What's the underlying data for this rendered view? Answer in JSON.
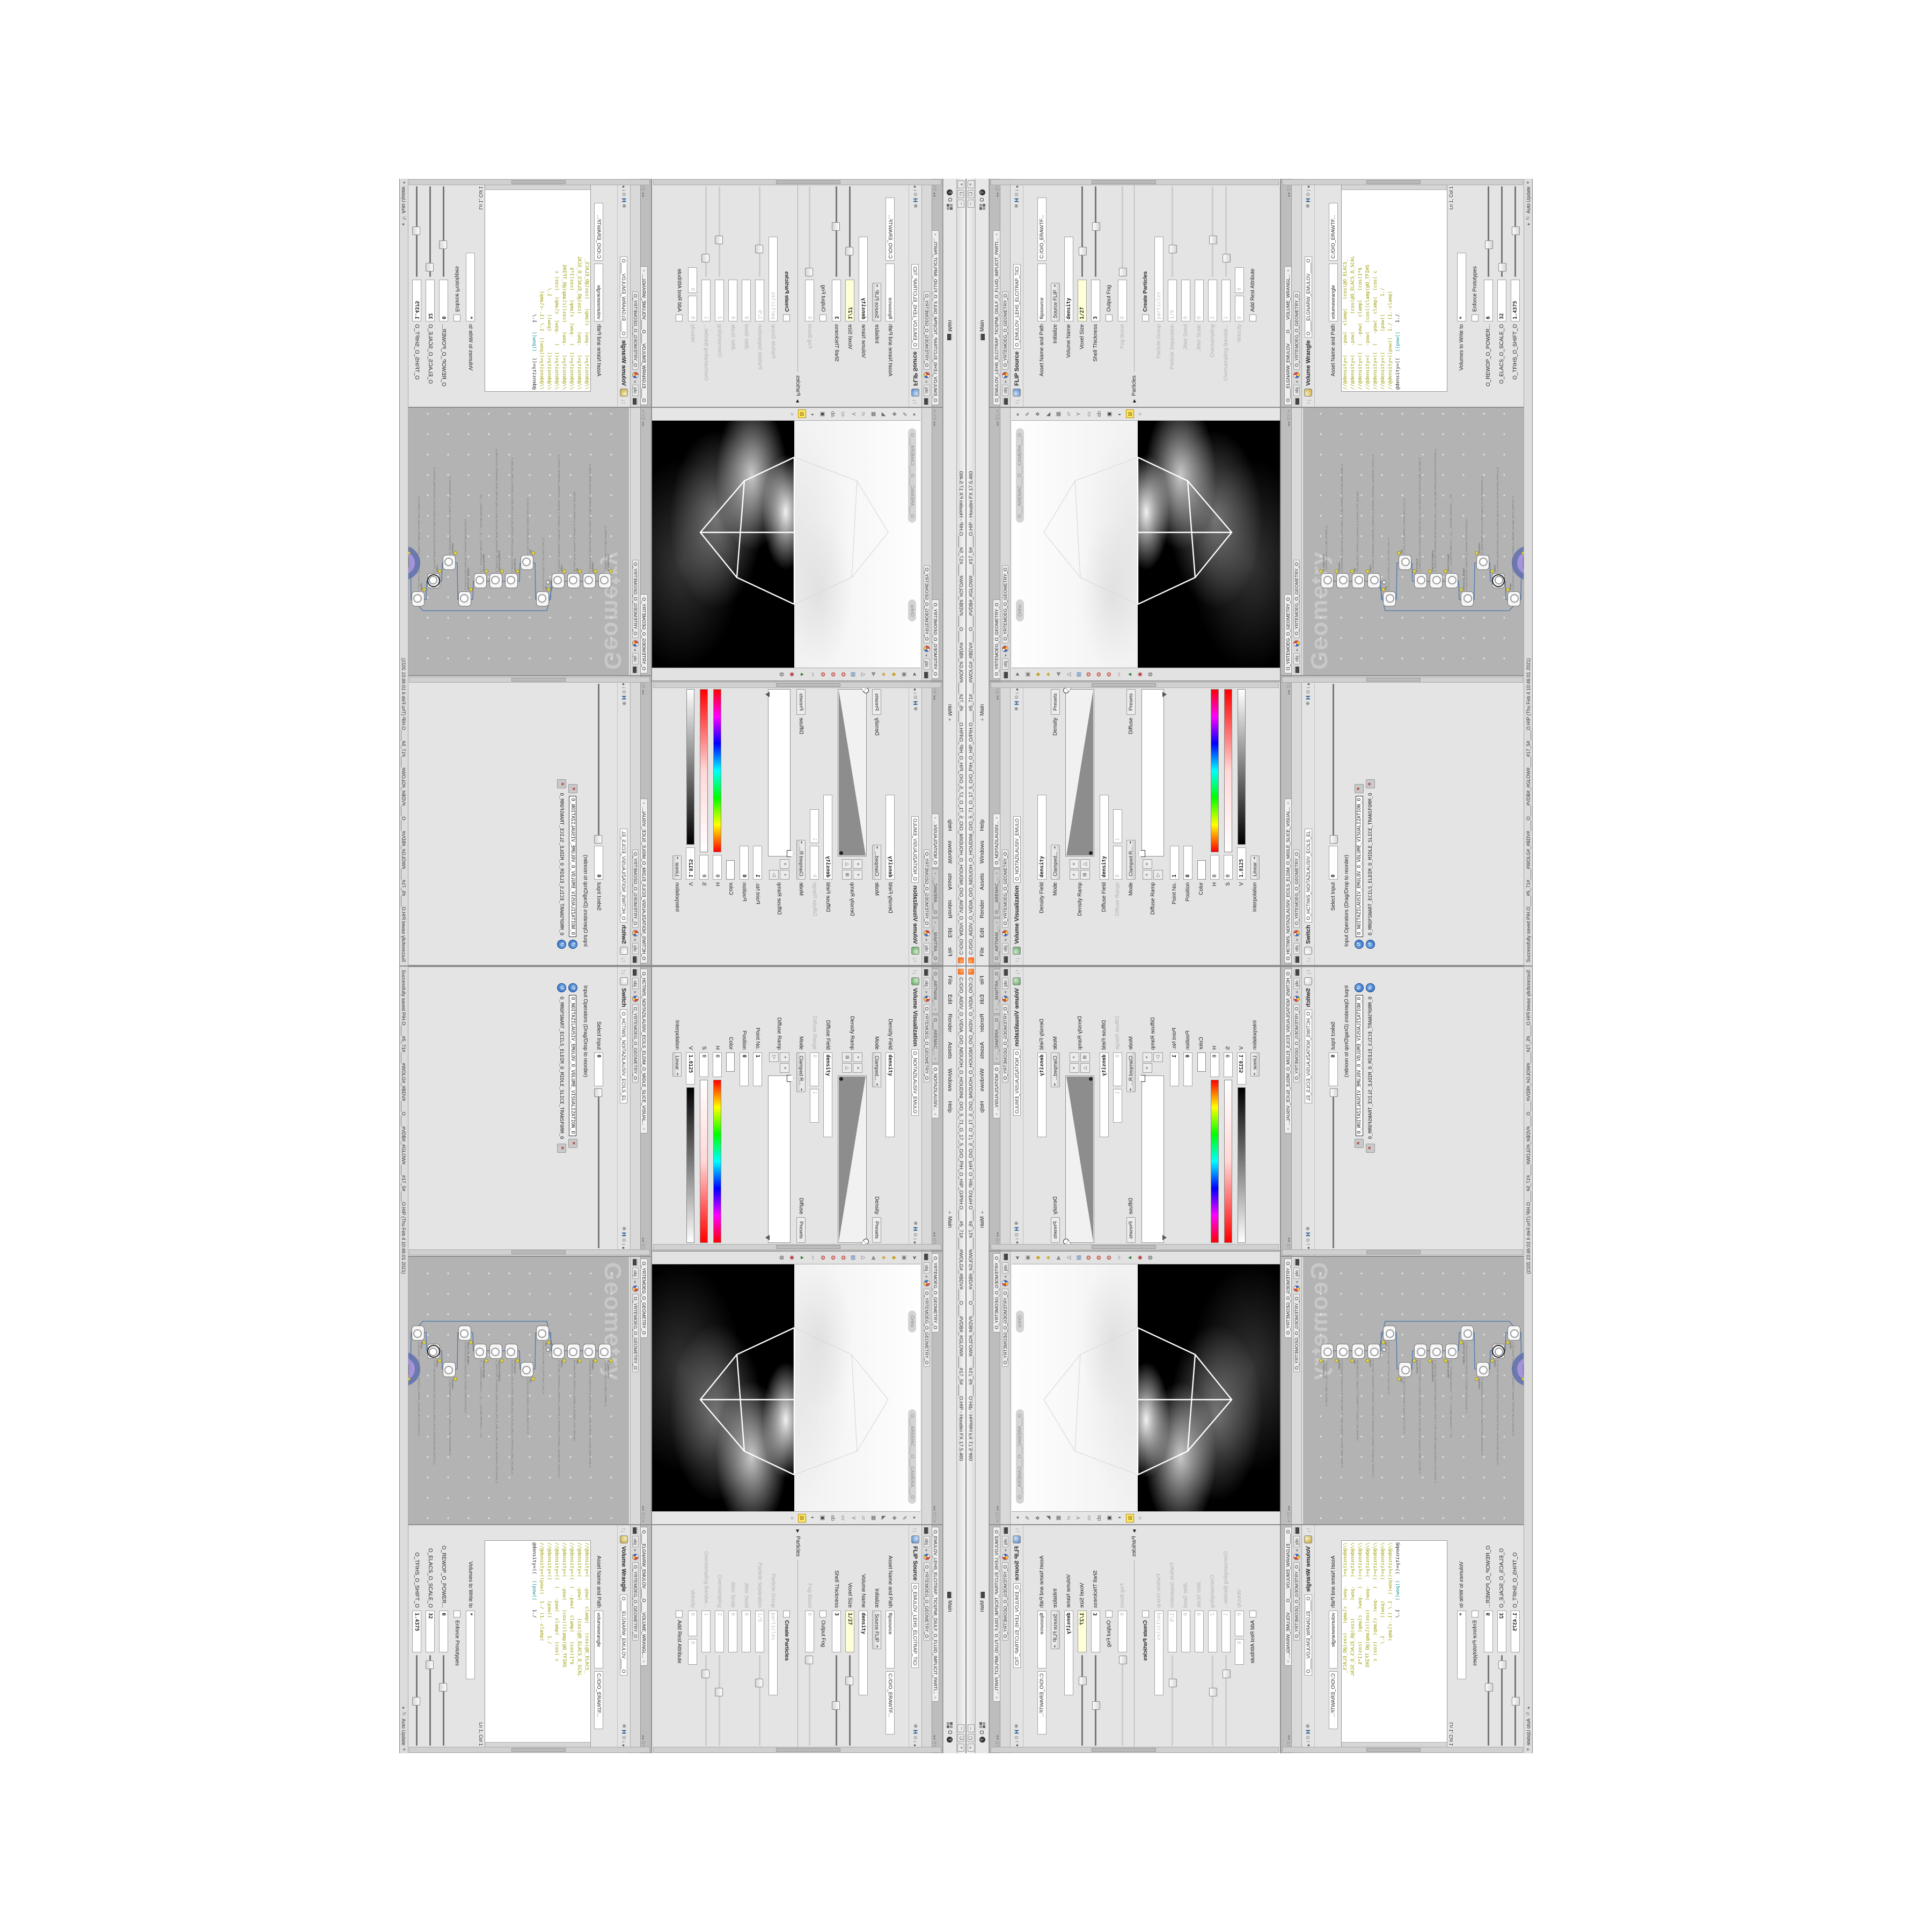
{
  "window": {
    "title": "C:/O/O_AIDIV_O_VIDIA_O/O_NIDUOH_O_HOUDINI_O/O_5_71_O_17_5_O/O_PIH_O_HIP_O/PIH.O____#5_71#____#WOLG#_#BDV#____O____#VDB#_#GLOW#____#17_5#____O.HIP - Houdini FX 17.5.460",
    "buttons": [
      "–",
      "❏",
      "×"
    ]
  },
  "menu": {
    "items": [
      "File",
      "Edit",
      "Render",
      "Assets",
      "Windows",
      "Help"
    ],
    "desktop_label": "Main",
    "desktop2_label": "Main",
    "right_o": "O"
  },
  "path": {
    "root": "obj",
    "node": "O_YRTEMOEG_O_GEOMETRY_O"
  },
  "statusbar": {
    "message": "Successfully saved PIH.O____#5_71#____#WOLG#_#BDV#____O____#VDB#_#GLOW#____#17_5#____O.HIP (Thu Feb  4 10:46:01 2021)",
    "auto_update": "Auto Update"
  },
  "viewport": {
    "tabs": [
      {
        "t": "O_YRTEMOEG_O_GEOMETRY_O",
        "active": true
      }
    ],
    "ortho_pill": "Ortho",
    "camera_pill": "O___AREMAC___O___CAMERA___O",
    "left_icons": [
      {
        "g": "➤",
        "c": "#555"
      },
      {
        "g": "▣",
        "c": "#777"
      },
      {
        "g": "◆",
        "c": "#c9a227"
      },
      {
        "g": "◈",
        "c": "#c9a227"
      },
      {
        "g": "◀",
        "c": "#888"
      },
      {
        "g": "△",
        "c": "#666"
      },
      {
        "g": "▤",
        "c": "#3a6bb0"
      },
      {
        "g": "❂",
        "c": "#c0392b"
      },
      {
        "g": "❂",
        "c": "#c0392b"
      },
      {
        "g": "❂",
        "c": "#c0392b"
      },
      {
        "g": "✂",
        "c": "#999"
      },
      {
        "g": "▲",
        "c": "#2e7d32"
      },
      {
        "g": "◉",
        "c": "#b03030"
      },
      {
        "g": "◍",
        "c": "#555"
      }
    ],
    "right_icons": [
      {
        "g": "▸",
        "c": "#777"
      },
      {
        "g": "✎",
        "c": "#666"
      },
      {
        "g": "❖",
        "c": "#666"
      },
      {
        "g": "◣",
        "c": "#666"
      },
      {
        "g": "▦",
        "c": "#666"
      },
      {
        "g": "▱",
        "c": "#666"
      },
      {
        "g": "Y",
        "c": "#666"
      },
      {
        "g": "▭",
        "c": "#666"
      },
      {
        "g": "ab",
        "c": "#666"
      },
      {
        "g": "▣",
        "c": "#444"
      },
      {
        "g": "◐",
        "c": "#444"
      },
      {
        "g": "⊞",
        "c": "#806000",
        "hl": true
      },
      {
        "g": "○",
        "c": "#555"
      }
    ]
  },
  "flip": {
    "tabs": [
      {
        "t": "O_EMULOV_LEHS_ELCITRAP_TICI(PMI_DIULF_O_FLUID_IMPLICIT_PARTI...",
        "x": true,
        "active": true
      }
    ],
    "header": {
      "title": "FLIP Source",
      "field": "O_EMULOV_LEHS_ELCITRAP_TICI"
    },
    "params": [
      {
        "label": "Asset Name and Path",
        "fields": [
          {
            "v": "flipsource",
            "w": 100
          },
          {
            "v": "C:/O/O_ERAWTF...",
            "w": 110
          }
        ]
      },
      {
        "label": "Initialize",
        "menu": "Source FLIP"
      },
      {
        "label": "Volume Name",
        "fields": [
          {
            "v": "density",
            "w": 150,
            "mono": true,
            "bold": true
          }
        ]
      },
      {
        "label": "Voxel Size",
        "fields": [
          {
            "v": "1/27",
            "w": 70,
            "mono": true,
            "bold": true,
            "yellow": true
          }
        ],
        "slider": 0.28
      },
      {
        "label": "Shell Thickness",
        "fields": [
          {
            "v": "3",
            "w": 70,
            "mono": true,
            "bold": true
          }
        ],
        "slider": 0.55
      },
      {
        "check": "Output Fog",
        "checked": false
      },
      {
        "label": "Fog Boost",
        "grey": true,
        "fields": [
          {
            "v": "0",
            "w": 70,
            "mono": true,
            "grey": true
          }
        ],
        "slider": 0.05,
        "sliderGrey": true
      },
      {
        "sep": "Particles"
      },
      {
        "check": "Create Particles",
        "bold": true,
        "checked": false
      },
      {
        "label": "Particle Group",
        "grey": true,
        "fields": [
          {
            "v": "particles",
            "w": 150,
            "mono": true,
            "grey": true
          }
        ]
      },
      {
        "label": "Particle Separation",
        "grey": true,
        "fields": [
          {
            "v": "1/9",
            "w": 70,
            "mono": true,
            "grey": true
          }
        ],
        "slider": 0.3,
        "sliderGrey": true
      },
      {
        "label": "Jitter Seed",
        "grey": true,
        "fields": [
          {
            "v": "0",
            "w": 70,
            "mono": true,
            "grey": true
          }
        ]
      },
      {
        "label": "Jitter Scale",
        "grey": true,
        "fields": [
          {
            "v": "0",
            "w": 70,
            "mono": true,
            "grey": true
          }
        ]
      },
      {
        "label": "Oversampling",
        "grey": true,
        "fields": [
          {
            "v": "2",
            "w": 70,
            "mono": true,
            "grey": true
          }
        ],
        "slider": 0.4,
        "sliderGrey": true
      },
      {
        "label": "Oversampling Bandwi...",
        "grey": true,
        "fields": [
          {
            "v": "1",
            "w": 70,
            "mono": true,
            "grey": true
          }
        ],
        "slider": 0.2,
        "sliderGrey": true
      },
      {
        "label": "Velocity",
        "grey": true,
        "fields": [
          {
            "v": "0",
            "w": 40,
            "mono": true,
            "grey": true
          },
          {
            "v": "0",
            "w": 40,
            "mono": true,
            "grey": true
          }
        ]
      },
      {
        "check": "Add Rest Attribute",
        "checked": false
      }
    ]
  },
  "volviz": {
    "tabs": [
      {
        "t": "O__ARTNAM_...",
        "x": true
      },
      {
        "t": "O___AREMAC_...",
        "x": true
      },
      {
        "t": "O_NOITAZILAUSIV...",
        "x": true,
        "active": true
      }
    ],
    "header": {
      "title": "Volume Visualization",
      "field": "O_NOITAZILAUSIV_EMULO"
    },
    "params": [
      {
        "label": "Density Field",
        "fields": [
          {
            "v": "density",
            "w": 150,
            "mono": true,
            "bold": true
          }
        ]
      },
      {
        "label": "Mode",
        "menu": "Clamped...",
        "after": "Density",
        "btn": "Presets"
      },
      {
        "label": "Density Ramp",
        "rampWedge": true
      },
      {
        "label": "Diffuse Field",
        "fields": [
          {
            "v": "density",
            "w": 150,
            "mono": true,
            "bold": true
          }
        ]
      },
      {
        "label": "Diffuse Range",
        "grey": true,
        "fields": [
          {
            "v": "0",
            "w": 55,
            "mono": true,
            "grey": true
          },
          {
            "v": "1",
            "w": 55,
            "mono": true,
            "grey": true
          }
        ]
      },
      {
        "label": "Mode",
        "menu": "Clamped R...",
        "after": "Diffuse",
        "btn": "Presets"
      },
      {
        "label": "Diffuse Ramp",
        "rampBar": true
      },
      {
        "label": "Point No.",
        "fields": [
          {
            "v": "1",
            "w": 55,
            "mono": true,
            "bold": true
          }
        ]
      },
      {
        "label": "Position",
        "fields": [
          {
            "v": "0",
            "w": 55,
            "mono": true,
            "bold": true
          }
        ]
      },
      {
        "label": "Color",
        "swatch": "#ffffff"
      },
      {
        "label": "H",
        "fields": [
          {
            "v": "0",
            "w": 38,
            "mono": true
          }
        ],
        "grad": "hue"
      },
      {
        "label": "S",
        "fields": [
          {
            "v": "0",
            "w": 38,
            "mono": true
          }
        ],
        "grad": "sat"
      },
      {
        "label": "V",
        "fields": [
          {
            "v": "1.8125",
            "w": 52,
            "mono": true,
            "bold": true
          }
        ],
        "grad": "val"
      },
      {
        "label": "Interpolation",
        "menu": "Linear"
      }
    ]
  },
  "wrangle": {
    "tabs": [
      {
        "t": "O____ELGNARW_EMULOV____O____VOLUME_WRANGL...",
        "x": true,
        "active": true
      }
    ],
    "header": {
      "title": "Volume Wrangle",
      "field": "O____ELGNARW_EMULOV____O"
    },
    "asset_row": {
      "label": "Asset Name and Path",
      "fields": [
        {
          "v": "volumewrangle",
          "w": 100
        },
        {
          "v": "C:/O/O_ERAWTF...",
          "w": 100
        }
      ]
    },
    "code": [
      {
        "pre": "//@density=(   -pow(  clamp(   (cos(@O_ELACS_"
      },
      {
        "pre": "//@density=(   -pow(      (cos(@O_ELACS_O_SCAL"
      },
      {
        "pre": ""
      },
      {
        "pre": "//@density=((  (  -pow(  clamp(   (cos(1*$"
      },
      {
        "pre": "//@density=(   -pow(   (cos((clamp(@O_TFIHS"
      },
      {
        "pre": ""
      },
      {
        "pre": "//@density=((  (   -pow(  clamp(  (cos( c"
      },
      {
        "pre": "//@density=((       (pow((      1./"
      },
      {
        "pre": "//@density=((pow((  1./ (1.-clamp("
      },
      {
        "pre": ""
      },
      {
        "pre": "@density=((  ",
        "hl": "((pow((",
        "post": "   1./",
        "black": true
      }
    ],
    "ln_col": "Ln 1, Col 1",
    "params": [
      {
        "label": "Volumes to Write to",
        "fields": [
          {
            "v": "*",
            "w": 120,
            "mono": true,
            "bold": true
          }
        ]
      },
      {
        "check": "Enforce Prototypes",
        "checked": false
      },
      {
        "label": "O_REWOP_O_POWER...",
        "fields": [
          {
            "v": "6",
            "w": 70,
            "mono": true,
            "bold": true
          }
        ],
        "slider": 0.35
      },
      {
        "label": "O_ELACS_O_SCALE_O",
        "fields": [
          {
            "v": "32",
            "w": 70,
            "mono": true,
            "bold": true
          }
        ],
        "slider": 0.1
      },
      {
        "label": "O_TFIHS_O_SHIFT_O",
        "fields": [
          {
            "v": "1.4375",
            "w": 70,
            "mono": true,
            "bold": true
          }
        ],
        "slider": 0.5
      }
    ]
  },
  "switch": {
    "tabs": [
      {
        "t": "O_HCTIWS_NOITAZILAUSIV_ECILS_ELDIM_O_MIDLE_SLICE_VISUAL...",
        "x": true,
        "active": true
      }
    ],
    "header": {
      "title": "Switch",
      "field": "O_HCTIWS_NOITAZILAUSIV_ECILS_EL"
    },
    "params": [
      {
        "label": "Select Input",
        "fields": [
          {
            "v": "0",
            "w": 55,
            "mono": true,
            "bold": true
          }
        ],
        "slider": 0.02
      },
      {
        "plain": "Input Operators (Drag/Drop to reorder)"
      },
      {
        "opitem": "O_NOITAZILAUSIV_EMULOV_O_VOLUME_VISUALIZATION_O",
        "boxed": true
      },
      {
        "opitem": "O_MROFSNART_ECILS_ELDIM_O_MIDLE_SLICE_TRANSFORM_O"
      }
    ]
  },
  "network": {
    "tabs": [
      {
        "t": "O_YRTEMOEG_O_GEOMETRY_O",
        "active": true
      }
    ],
    "watermark": "Geometry",
    "nodes": [
      {
        "label": "ae_CubeSphere",
        "name": "O_ERHPS_ENUC_O_CUBE_SPHERE_O",
        "col": 0
      },
      {
        "label": "PolyWire",
        "name": "O_EMARFERIW_NOGYLOP_EREHPS_ENUC_O_CUBE_SPHERE_POLYGON_WIREFRAME_O",
        "col": 0
      },
      {
        "label": "File",
        "name": "JBO.MD3_PETS_TREPOLS_O_SUNEG_O_SLOPERT_STEP_3DM.OBJ",
        "col": 0
      },
      {
        "label": "Switch",
        "name": "O_HCTIWS_YRTEMOEG_LANRETXE_LANRETNI_O_INTERNAL_EXTERNAL_GEOMETRY_SWITCH_O",
        "col": 0
      },
      {
        "label": "Clip",
        "name": "O_PILC_FLAH_TFEL_O_LEFT_HALF_CLIP_O",
        "col": -1
      },
      {
        "label": "Clip",
        "name": "O_PILC_FLAH_THGIR_O_RIGHT_HALF_CLIP_O",
        "col": 1
      },
      {
        "label": "FLIP Source",
        "name": "O_EMULOV_LEHS_ELCITRAP_TICI(PMI_DIULF_O_FLUID_IMPLICIT_PARTICLE_SHEL_VOLUME_O",
        "col": 0
      },
      {
        "label": "VDB from Polygons",
        "name": "O_SNOGYLOP_YRTEMOEG_MORF_EMULOV_BDV_O_VDB_VOLUME_FROM_GEOMETRY_POLYGONS_O",
        "col": 0
      },
      {
        "label": "Volume Wrangle",
        "name": "O____ELGNARW_EMULOV____O____VOLUME_WRANGLE____O2",
        "col": 0
      },
      {
        "label": "Volume Visualization",
        "name": "O_NOITAZILAUSIV_EMULOV_O_VOLUME_VISUALIZATION_O",
        "col": -1
      },
      {
        "label": "Transform",
        "name": "O_MROFSNART_ECILS_ELDIM_O_MIDLE_SLICE_TRANSFORM_O",
        "col": 1
      },
      {
        "label": "Switch",
        "name": "O_HCTIWS_NOITAZILAUSIV_ECILS_ELDIM_O_MIDLE_SLICE_VISUALIZATION_SWITCH_O",
        "col": 0,
        "ring": true
      },
      {
        "label": "Merge",
        "name": "O_ECAFRUS_HTIW_EMULOV_EGREM_O_MERGE_VOLUME_WITH_SURFACE_O",
        "col": -1
      },
      {
        "label": "Transform",
        "name": "O_MROFSNART_TLUSER_O_RESULT_TRANSFORM_O",
        "col": 1,
        "purple": true
      }
    ]
  },
  "header_icons": [
    "✻",
    "H",
    "⊙",
    "i",
    "●",
    "?"
  ],
  "pane_ctl_icons": [
    "◂",
    "▸",
    "▽",
    "□",
    "+"
  ],
  "colors": {
    "accent_purple": "#a48fe0",
    "ring_blue": "#5f6fae",
    "wire": "#5b7fae",
    "canvas": "#b3b3b3",
    "code_olive": "#9b9b00",
    "code_teal": "#0e8d8d",
    "field_yellow": "#ffffd6"
  }
}
